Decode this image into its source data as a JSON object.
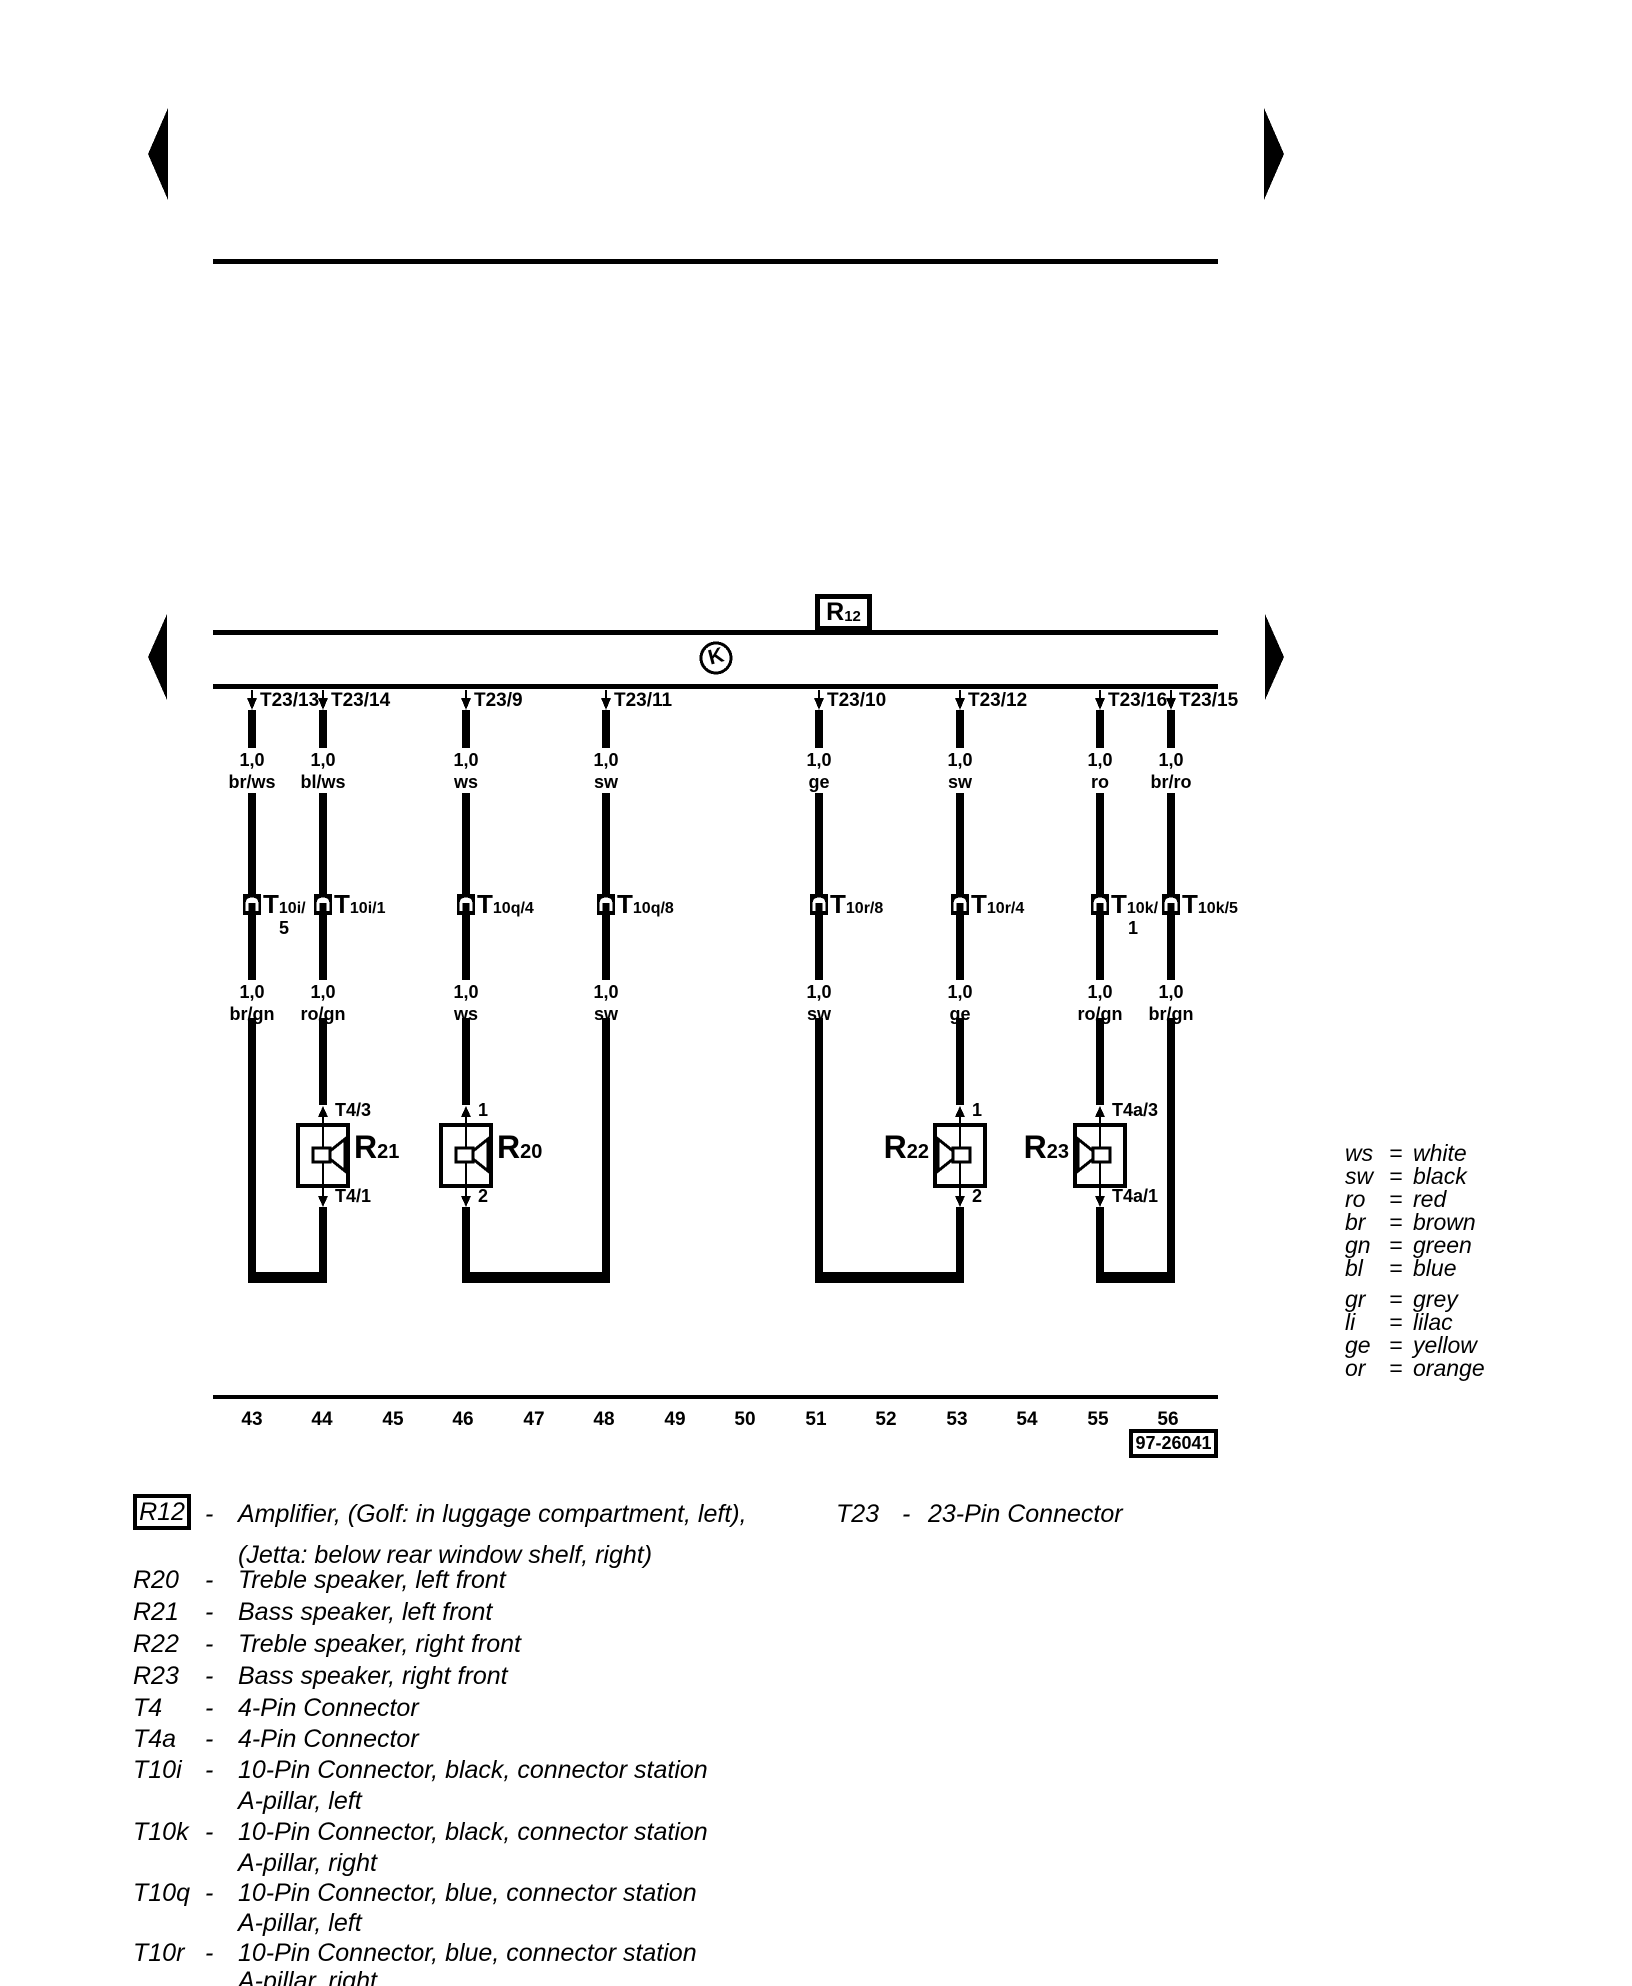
{
  "ui": {
    "dash": "-",
    "equals": "="
  },
  "diagram": {
    "component_box": {
      "prefix": "R",
      "sub": "12"
    },
    "junction_symbol": "K",
    "diagram_number": "97-26041",
    "wires": [
      {
        "pin": "T23/13",
        "gauge_top": "1,0",
        "color_top": "br/ws",
        "conn_prefix": "T",
        "conn_rest": "10i/",
        "conn_below": "5",
        "gauge_bottom": "1,0",
        "color_bottom": "br/gn"
      },
      {
        "pin": "T23/14",
        "gauge_top": "1,0",
        "color_top": "bl/ws",
        "conn_prefix": "T",
        "conn_rest": "10i/1",
        "gauge_bottom": "1,0",
        "color_bottom": "ro/gn"
      },
      {
        "pin": "T23/9",
        "gauge_top": "1,0",
        "color_top": "ws",
        "conn_prefix": "T",
        "conn_rest": "10q/4",
        "gauge_bottom": "1,0",
        "color_bottom": "ws"
      },
      {
        "pin": "T23/11",
        "gauge_top": "1,0",
        "color_top": "sw",
        "conn_prefix": "T",
        "conn_rest": "10q/8",
        "gauge_bottom": "1,0",
        "color_bottom": "sw"
      },
      {
        "pin": "T23/10",
        "gauge_top": "1,0",
        "color_top": "ge",
        "conn_prefix": "T",
        "conn_rest": "10r/8",
        "gauge_bottom": "1,0",
        "color_bottom": "sw"
      },
      {
        "pin": "T23/12",
        "gauge_top": "1,0",
        "color_top": "sw",
        "conn_prefix": "T",
        "conn_rest": "10r/4",
        "gauge_bottom": "1,0",
        "color_bottom": "ge"
      },
      {
        "pin": "T23/16",
        "gauge_top": "1,0",
        "color_top": "ro",
        "conn_prefix": "T",
        "conn_rest": "10k/",
        "conn_below": "1",
        "gauge_bottom": "1,0",
        "color_bottom": "ro/gn"
      },
      {
        "pin": "T23/15",
        "gauge_top": "1,0",
        "color_top": "br/ro",
        "conn_prefix": "T",
        "conn_rest": "10k/5",
        "gauge_bottom": "1,0",
        "color_bottom": "br/gn"
      }
    ],
    "speakers": [
      {
        "prefix": "R",
        "sub": "21",
        "pin_top": "T4/3",
        "pin_bottom": "T4/1"
      },
      {
        "prefix": "R",
        "sub": "20",
        "pin_top": "1",
        "pin_bottom": "2"
      },
      {
        "prefix": "R",
        "sub": "22",
        "pin_top": "1",
        "pin_bottom": "2"
      },
      {
        "prefix": "R",
        "sub": "23",
        "pin_top": "T4a/3",
        "pin_bottom": "T4a/1"
      }
    ],
    "tracks": [
      "43",
      "44",
      "45",
      "46",
      "47",
      "48",
      "49",
      "50",
      "51",
      "52",
      "53",
      "54",
      "55",
      "56"
    ],
    "wire_colors_legend": [
      {
        "abbr": "ws",
        "name": "white"
      },
      {
        "abbr": "sw",
        "name": "black"
      },
      {
        "abbr": "ro",
        "name": "red"
      },
      {
        "abbr": "br",
        "name": "brown"
      },
      {
        "abbr": "gn",
        "name": "green"
      },
      {
        "abbr": "bl",
        "name": "blue"
      },
      {
        "abbr": "gr",
        "name": "grey"
      },
      {
        "abbr": "li",
        "name": "lilac"
      },
      {
        "abbr": "ge",
        "name": "yellow"
      },
      {
        "abbr": "or",
        "name": "orange"
      }
    ],
    "component_legend": [
      {
        "key": "R12",
        "line1": "Amplifier, (Golf: in luggage compartment, left),",
        "line2": "(Jetta: below rear window shelf, right)"
      },
      {
        "key": "R20",
        "line1": "Treble speaker, left front"
      },
      {
        "key": "R21",
        "line1": "Bass speaker, left front"
      },
      {
        "key": "R22",
        "line1": "Treble speaker, right front"
      },
      {
        "key": "R23",
        "line1": "Bass speaker, right front"
      },
      {
        "key": "T4",
        "line1": "4-Pin Connector"
      },
      {
        "key": "T4a",
        "line1": "4-Pin Connector"
      },
      {
        "key": "T10i",
        "line1": "10-Pin Connector, black, connector station",
        "line2": "A-pillar, left"
      },
      {
        "key": "T10k",
        "line1": "10-Pin Connector, black, connector station",
        "line2": "A-pillar, right"
      },
      {
        "key": "T10q",
        "line1": "10-Pin Connector, blue, connector station",
        "line2": "A-pillar, left"
      },
      {
        "key": "T10r",
        "line1": "10-Pin Connector, blue, connector station",
        "line2": "A-pillar, right"
      }
    ],
    "t23_legend": {
      "key": "T23",
      "line1": "23-Pin Connector"
    }
  }
}
